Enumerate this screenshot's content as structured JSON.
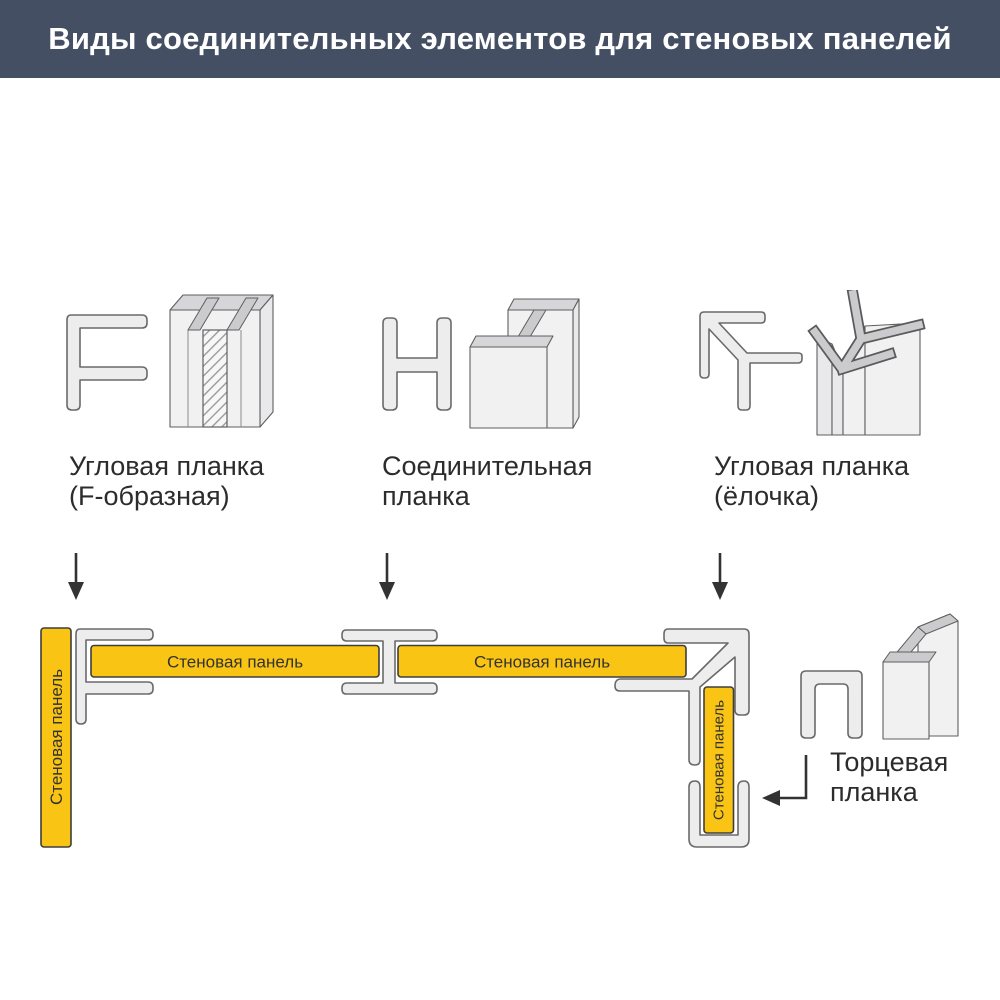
{
  "title": "Виды соединительных элементов для стеновых панелей",
  "colors": {
    "header_bg": "#454f64",
    "panel_yellow": "#f9c413",
    "profile_fill": "#ededed",
    "profile_stroke": "#6a6a6a",
    "band_fill": "#cbcbce",
    "ink": "#2c2c2c"
  },
  "profiles": [
    {
      "caption_line1": "Угловая планка",
      "caption_line2": "(F-образная)"
    },
    {
      "caption_line1": "Соединительная",
      "caption_line2": "планка"
    },
    {
      "caption_line1": "Угловая планка",
      "caption_line2": "(ёлочка)"
    }
  ],
  "assembly": {
    "panel_label": "Стеновая панель",
    "end_cap": {
      "caption_line1": "Торцевая",
      "caption_line2": "планка"
    }
  }
}
